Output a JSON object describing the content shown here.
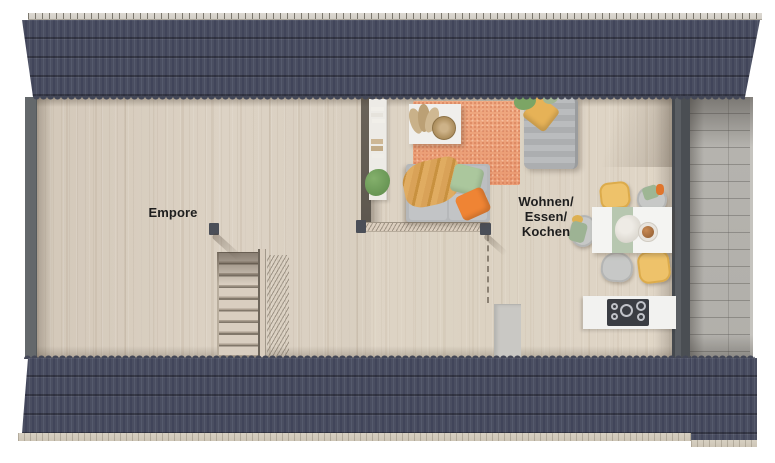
{
  "plan": {
    "labels": {
      "empore": "Empore",
      "living_lines": [
        "Wohnen/",
        "Essen/",
        "Kochen"
      ]
    },
    "colors": {
      "roof": "#4a4e61",
      "roof_ridge": "#d8d4cd",
      "gable_wall": "#64686b",
      "partition_wall": "#515459",
      "wood_floor": "#d8cec0",
      "balcony_tile": "#b3b1ac",
      "rug": "#eea47e",
      "sofa_gray": "#b6b8ba",
      "accent_yellow": "#eec26a",
      "accent_green": "#a9c69c",
      "accent_orange": "#ef8434",
      "furniture_white": "#f3f3f1",
      "runner_green": "#b7c7b0",
      "cooktop": "#3a3d43",
      "label_text": "#1e1e1e"
    },
    "furniture": [
      "staircase",
      "stair-railing",
      "gallery-railing",
      "wall-shelf",
      "coffee-table",
      "rug",
      "sofa",
      "lounge-chair",
      "dining-table",
      "dining-chairs",
      "kitchen-counter",
      "cooktop",
      "balcony"
    ]
  }
}
